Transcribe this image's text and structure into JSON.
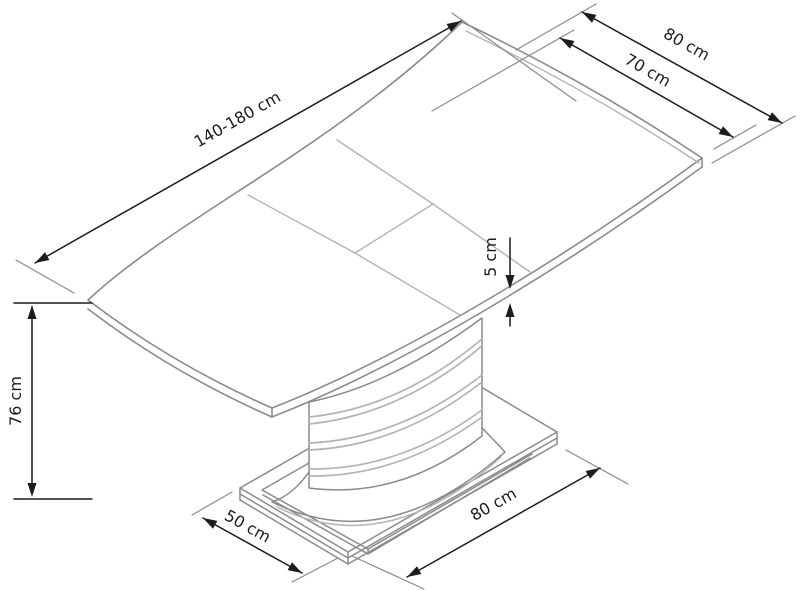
{
  "diagram": {
    "subject": "Extendable pedestal table — isometric dimension drawing",
    "background": "#ffffff",
    "colors": {
      "dimension": "#1c1c1c",
      "outline": "#8a8a8a",
      "detail": "#b3b3b3"
    },
    "labels": {
      "length": "140-180 cm",
      "top_end_width": "80 cm",
      "top_inner_width": "70 cm",
      "top_thickness": "5 cm",
      "height": "76 cm",
      "base_depth": "50 cm",
      "base_width": "80 cm"
    }
  }
}
